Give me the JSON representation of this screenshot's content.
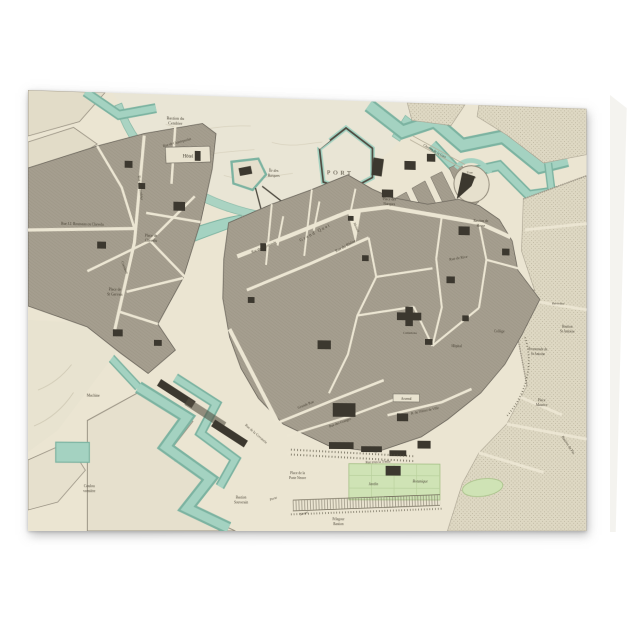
{
  "map": {
    "colors": {
      "water": "#a4d2c1",
      "water_edge": "#7cb3a1",
      "block": "#a59e8f",
      "block_line": "#958e7d",
      "dark_building": "#3c382f",
      "paper": "#ebe5d2",
      "lake": "#e9e5d5",
      "green": "#cfe3b5",
      "green_edge": "#a9c28a",
      "stipple": "#ded8c3",
      "label_text": "#443e31"
    },
    "labels": {
      "port": "PORT",
      "bastion_cendrier_1": "Bastion du",
      "bastion_cendrier_2": "Cendrier",
      "hotel": "Hôtel",
      "rue_cendrier": "Rue du Cendrier",
      "chantepoulet": "Rue de Chantepoulet",
      "place_chevelu_1": "Place de",
      "place_chevelu_2": "Chevelu",
      "rousseau": "Rue J.J. Rousseau ou Chevelu",
      "st_gervais_1": "Place de",
      "st_gervais_2": "St Gervais",
      "coutance": "Coutance",
      "ile_barques_1": "Île des",
      "ile_barques_2": "Barques",
      "place_barques_1": "Place des",
      "place_barques_2": "Barques",
      "grand_quai": "Grand Quai",
      "rue_rhone": "Rue du Rhône",
      "chemin_gare": "Chemin de la Gare",
      "tour_maitresse_1": "Tour",
      "tour_maitresse_2": "Maîtresse",
      "bastion_hesse_1": "Bastion de",
      "bastion_hesse_2": "Hesse",
      "rue_rive": "Rue de Rive",
      "allemands": "Rue des Allemands",
      "molard": "Molard",
      "grande_rue": "Grande Rue",
      "granges": "Rue des Granges",
      "corraterie": "Rue de la Corraterie",
      "hotel_ville": "R. de l'Hôtel de Ville",
      "arsenal": "Arsenal",
      "cathedrale": "Cathédrale",
      "hopital": "Hôpital",
      "college": "Collège",
      "belvedere": "Belvédère",
      "bastion_st_antoine_1": "Bastion",
      "bastion_st_antoine_2": "St Antoine",
      "promenade_1": "Promenade de",
      "promenade_2": "St Antoine",
      "place_maurice_1": "Place",
      "place_maurice_2": "Maurice",
      "bastion_pin": "Bastion du Pin",
      "treille": "Rue sous la Treille",
      "porte_neuve_pl_1": "Place de la",
      "porte_neuve_pl_2": "Porte Neuve",
      "porte": "Porte",
      "neuve": "Neuve",
      "jardin": "Jardin",
      "botanique": "Botanique",
      "bastion_souverain_1": "Bastion",
      "bastion_souverain_2": "Souverain",
      "pelegour_1": "Pélegour",
      "pelegour_2": "Bastion",
      "coulouvreniere_1": "Coulou",
      "coulouvreniere_2": "vrenière",
      "machine": "Machine"
    }
  }
}
